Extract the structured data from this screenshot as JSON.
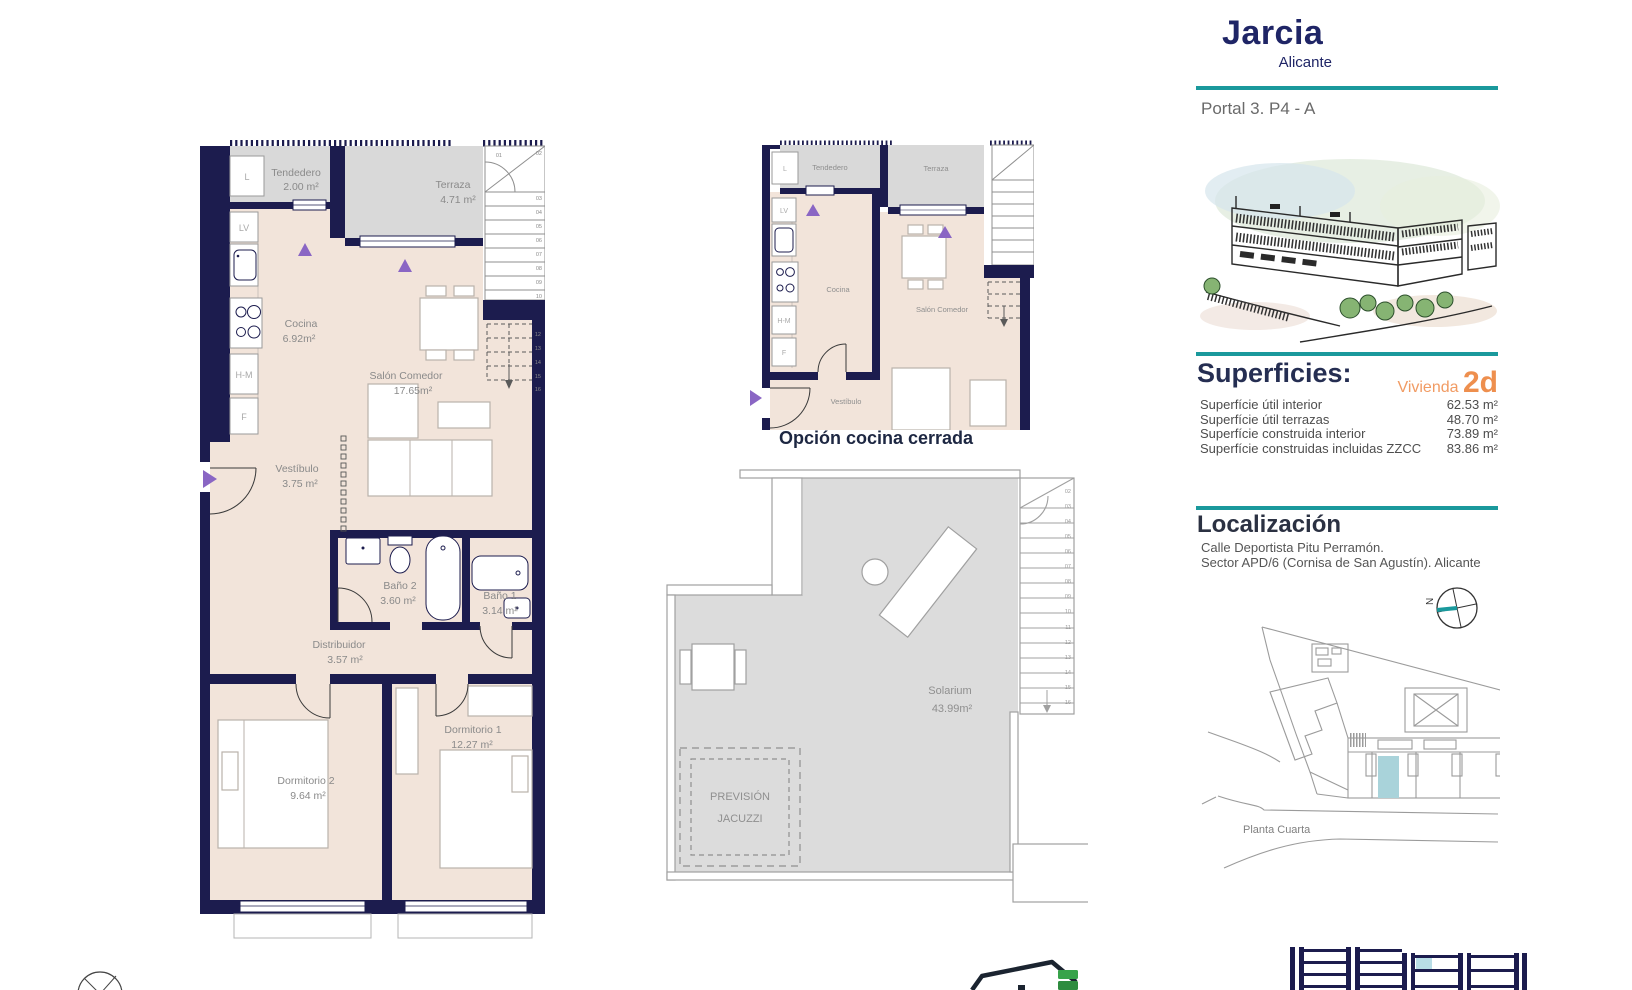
{
  "header": {
    "title": "Jarcia",
    "subtitle": "Alicante",
    "portal": "Portal 3. P4 - A"
  },
  "superficies": {
    "heading": "Superficies:",
    "vivienda_label": "Vivienda",
    "vivienda_value": "2d",
    "rows": [
      {
        "label": "Superfície útil interior",
        "value": "62.53 m²"
      },
      {
        "label": "Superfície útil terrazas",
        "value": "48.70 m²"
      },
      {
        "label": "Superfície construida interior",
        "value": "73.89 m²"
      },
      {
        "label": "Superfície construidas incluidas ZZCC",
        "value": "83.86 m²"
      }
    ]
  },
  "localizacion": {
    "heading": "Localización",
    "address_line1": "Calle Deportista Pitu Perramón.",
    "address_line2": "Sector APD/6 (Cornisa de San Agustín). Alicante",
    "floor_label": "Planta Cuarta",
    "compass_label": "N"
  },
  "main_plan": {
    "rooms": [
      {
        "name": "Tendedero",
        "area": "2.00 m²"
      },
      {
        "name": "Terraza",
        "area": "4.71 m²"
      },
      {
        "name": "Cocina",
        "area": "6.92m²"
      },
      {
        "name": "Salón Comedor",
        "area": "17.65m²"
      },
      {
        "name": "Vestíbulo",
        "area": "3.75 m²"
      },
      {
        "name": "Baño 2",
        "area": "3.60 m²"
      },
      {
        "name": "Baño 1",
        "area": "3.14 m²"
      },
      {
        "name": "Distribuidor",
        "area": "3.57 m²"
      },
      {
        "name": "Dormitorio 1",
        "area": "12.27 m²"
      },
      {
        "name": "Dormitorio 2",
        "area": "9.64 m²"
      }
    ],
    "kitchen_labels": [
      "L",
      "LV",
      "H-M",
      "F"
    ],
    "stairs_upper": [
      "01",
      "02",
      "03",
      "04",
      "05",
      "06",
      "07",
      "08",
      "09",
      "10"
    ],
    "stairs_dashed": [
      "12",
      "13",
      "14",
      "15",
      "16"
    ]
  },
  "small_plan": {
    "caption": "Opción cocina cerrada",
    "rooms": [
      "Tendedero",
      "Terraza",
      "Cocina",
      "Salón Comedor",
      "Vestíbulo"
    ],
    "kitchen_labels": [
      "L",
      "LV",
      "H-M",
      "F"
    ]
  },
  "solarium_plan": {
    "room": "Solarium",
    "area": "43.99m²",
    "jacuzzi_line1": "PREVISIÓN",
    "jacuzzi_line2": "JACUZZI",
    "stairs": [
      "02",
      "03",
      "04",
      "05",
      "06",
      "07",
      "08",
      "09",
      "10",
      "11",
      "12",
      "13",
      "14",
      "15",
      "16"
    ]
  },
  "colors": {
    "wall": "#1c1c4e",
    "floor": "#f2e4da",
    "terrace": "#d9d9d9",
    "accent_teal": "#1a999c",
    "accent_orange": "#ee8f4e",
    "highlight_unit": "#a9d3da"
  }
}
